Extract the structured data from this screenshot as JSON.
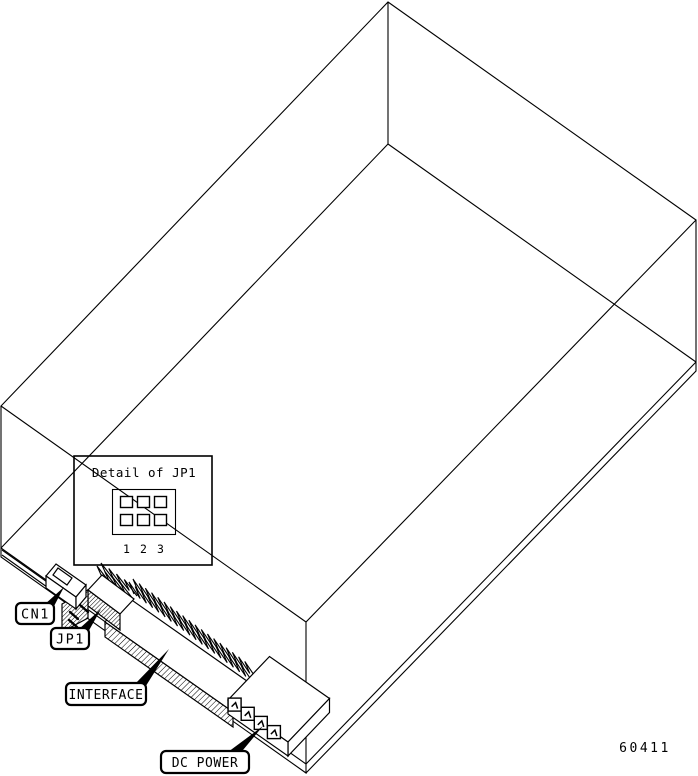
{
  "diagram": {
    "inset_title": "Detail of JP1",
    "jumper_pins": [
      "1",
      "2",
      "3"
    ],
    "labels": {
      "cn1": "CN1",
      "jp1": "JP1",
      "interface": "INTERFACE",
      "dc_power": "DC POWER"
    },
    "figure_number": "60411",
    "colors": {
      "line": "#000000",
      "background": "#ffffff"
    }
  }
}
